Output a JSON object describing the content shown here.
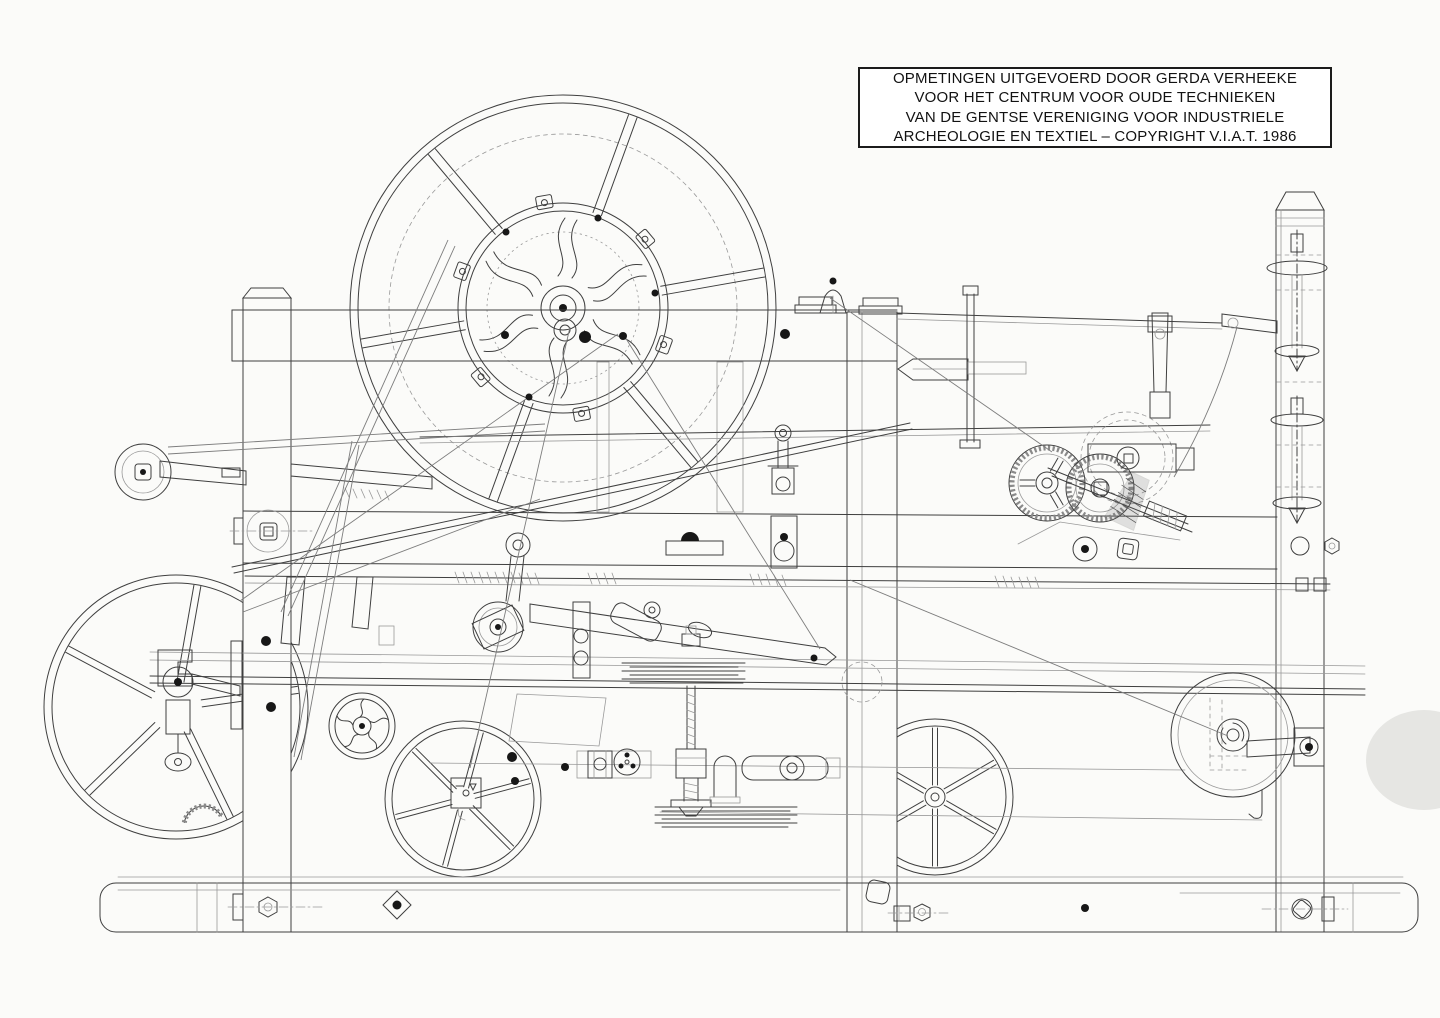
{
  "page": {
    "width": 1440,
    "height": 1018,
    "background": "#fbfbf9"
  },
  "colors": {
    "ink": "#3f3f3f",
    "ink_light": "#999999",
    "ink_dark": "#171717",
    "paper": "#fbfbf9",
    "smudge": "#cbcbc8",
    "box_border": "#1b1b1b",
    "box_text": "#121212"
  },
  "title_box": {
    "lines": [
      "OPMETINGEN UITGEVOERD DOOR GERDA VERHEEKE",
      "VOOR HET CENTRUM VOOR OUDE TECHNIEKEN",
      "VAN DE GENTSE VERENIGING VOOR INDUSTRIELE",
      "ARCHEOLOGIE EN TEXTIEL – COPYRIGHT V.I.A.T. 1986"
    ]
  }
}
